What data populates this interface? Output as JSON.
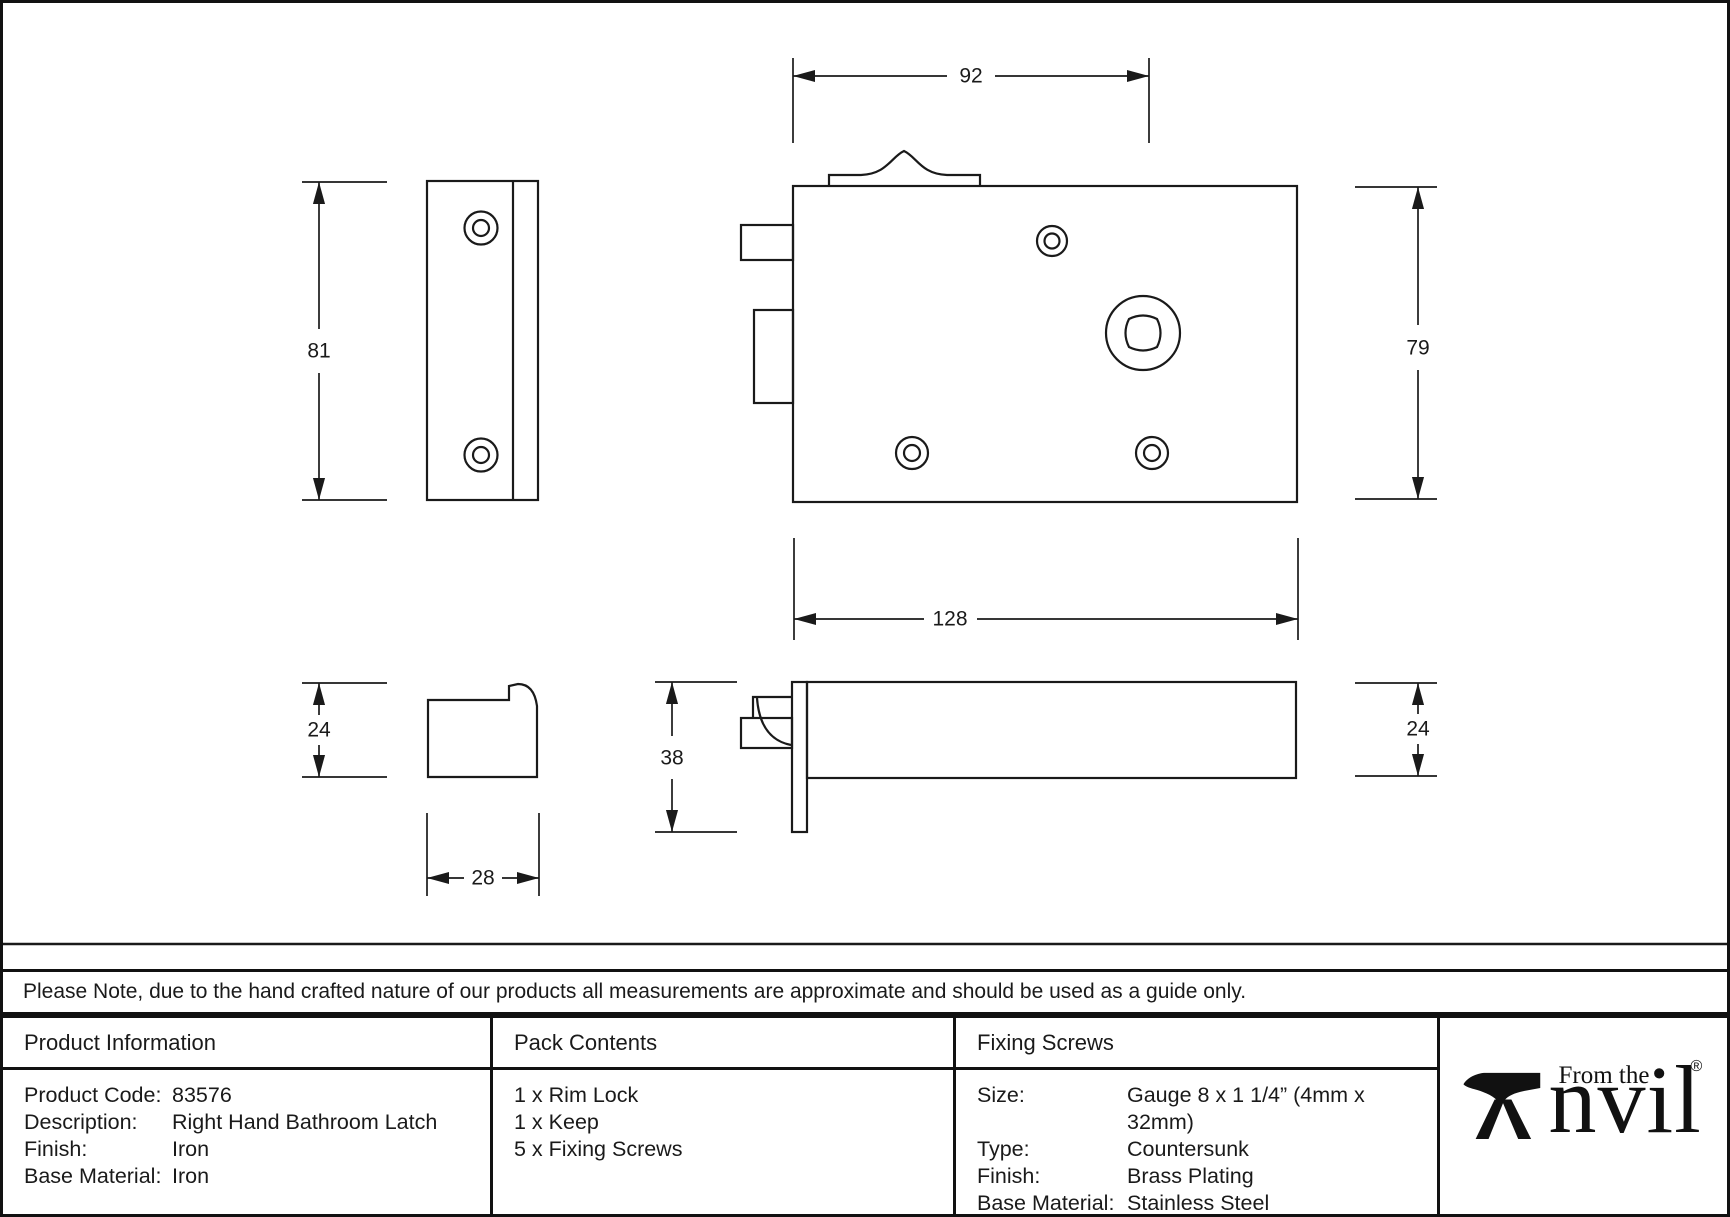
{
  "note": "Please Note, due to the hand crafted nature of our products all measurements are approximate and should be used as a guide only.",
  "drawing": {
    "dims": {
      "top_width": "92",
      "keep_height": "81",
      "body_height": "79",
      "body_width": "128",
      "keep_profile_height": "24",
      "keep_profile_width": "28",
      "lock_profile_height": "38",
      "lock_profile_thickness": "24"
    }
  },
  "table": {
    "product_information": {
      "header": "Product Information",
      "rows": [
        {
          "label": "Product Code:",
          "value": "83576"
        },
        {
          "label": "Description:",
          "value": "Right Hand Bathroom Latch"
        },
        {
          "label": "Finish:",
          "value": "Iron"
        },
        {
          "label": "Base Material:",
          "value": "Iron"
        }
      ]
    },
    "pack_contents": {
      "header": "Pack Contents",
      "items": [
        "1 x Rim Lock",
        "1 x Keep",
        "5 x Fixing Screws"
      ]
    },
    "fixing_screws": {
      "header": "Fixing Screws",
      "rows": [
        {
          "label": "Size:",
          "value": "Gauge 8 x 1 1/4” (4mm x 32mm)"
        },
        {
          "label": "Type:",
          "value": "Countersunk"
        },
        {
          "label": "Finish:",
          "value": "Brass Plating"
        },
        {
          "label": "Base Material:",
          "value": "Stainless Steel"
        }
      ]
    }
  },
  "logo": {
    "prefix": "From the",
    "brand": "Anvil",
    "brand_suffix": "nvil",
    "registered": "®"
  },
  "colors": {
    "ink": "#1a1a1a",
    "background": "#ffffff"
  }
}
